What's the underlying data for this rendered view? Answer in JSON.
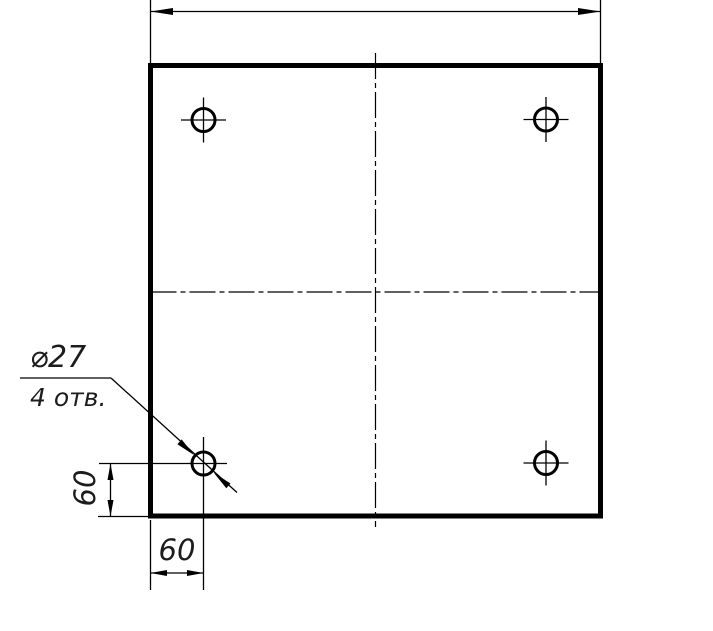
{
  "drawing": {
    "type": "technical-drawing",
    "background_color": "#ffffff",
    "line_color": "#000000",
    "text_color": "#1c1c1c",
    "callout": {
      "diameter_label": "⌀27",
      "hole_count_label": "4 отв."
    },
    "dimensions": {
      "vertical_offset": "60",
      "horizontal_offset": "60"
    }
  }
}
